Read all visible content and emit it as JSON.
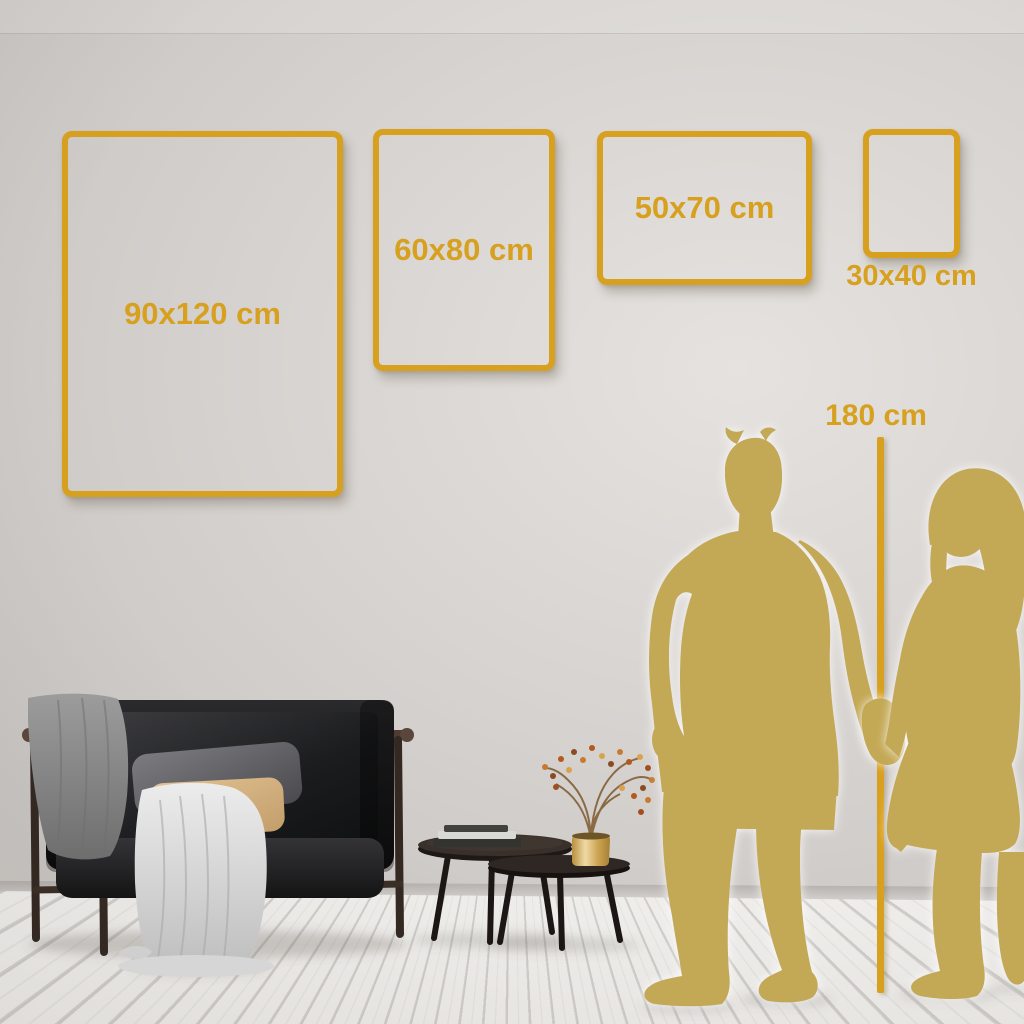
{
  "frames": [
    {
      "label": "90x120 cm",
      "width_cm": 90,
      "height_cm": 120
    },
    {
      "label": "60x80 cm",
      "width_cm": 60,
      "height_cm": 80
    },
    {
      "label": "50x70 cm",
      "width_cm": 50,
      "height_cm": 70
    },
    {
      "label": "30x40 cm",
      "width_cm": 30,
      "height_cm": 40
    }
  ],
  "height_marker": {
    "label": "180 cm",
    "height_cm": 180
  },
  "colors": {
    "accent_gold": "#D7A01F",
    "silhouette_gold": "#C3A855",
    "wall_light": "#E5E2DF",
    "wall_dark": "#C8C4C1",
    "floor_light": "#F6F5F3"
  }
}
